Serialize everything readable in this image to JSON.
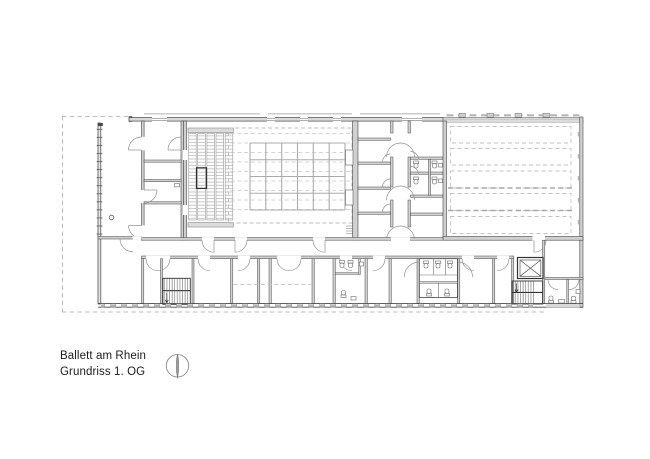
{
  "caption": {
    "title": "Ballett am Rhein",
    "subtitle": "Grundriss 1. OG"
  },
  "compass": {
    "icon": "north-arrow-icon"
  },
  "colors": {
    "background": "#ffffff",
    "ink": "#474747",
    "wall_fill": "#d9d9d9",
    "light_line": "#c2c2c2",
    "text": "#1c1c1c"
  }
}
